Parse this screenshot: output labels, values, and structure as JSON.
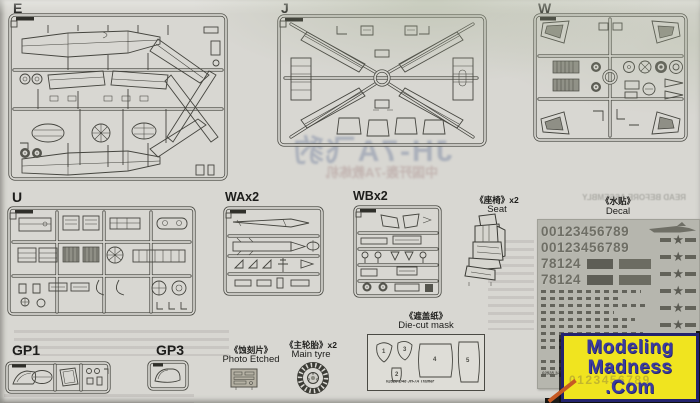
{
  "page": {
    "bg": "#d8d7d2",
    "ink": "#45453f"
  },
  "sprues": {
    "e": "E",
    "j": "J",
    "w": "W",
    "u": "U",
    "wa": "WAx2",
    "wb": "WBx2",
    "gp1": "GP1",
    "gp3": "GP3"
  },
  "sections": {
    "seat": {
      "cn": "《座椅》x2",
      "en": "Seat"
    },
    "decal": {
      "cn": "《水贴》",
      "en": "Decal"
    },
    "photo_etched": {
      "cn": "《蚀刻片》",
      "en": "Photo Etched"
    },
    "main_tyre": {
      "cn": "《主轮胎》x2",
      "en": "Main tyre"
    },
    "mask": {
      "cn": "《遮盖纸》",
      "en": "Die-cut mask",
      "caption": "02828 1/48 JH-7A Trainer",
      "numbers": [
        "1",
        "2",
        "3",
        "4",
        "5"
      ]
    }
  },
  "decal_sheet": {
    "number_rows": [
      "00123456789",
      "00123456789",
      "78124",
      "78124"
    ],
    "insignia_count": 6,
    "caption": "02828 1/48 JH-7A Trainer"
  },
  "watermark": {
    "line1": "Modeling",
    "line2": "Madness",
    "line3": ".Com",
    "ghost": "0123456789",
    "bg": "#f0e41f",
    "fg": "#3a3aa0"
  },
  "bleedthrough": {
    "title": "JH-7A飞豹",
    "subtitle": "中国歼轰-7A教练机",
    "note": "READ BEFORE ASSEMBLY"
  },
  "icons": {
    "star": "★"
  }
}
